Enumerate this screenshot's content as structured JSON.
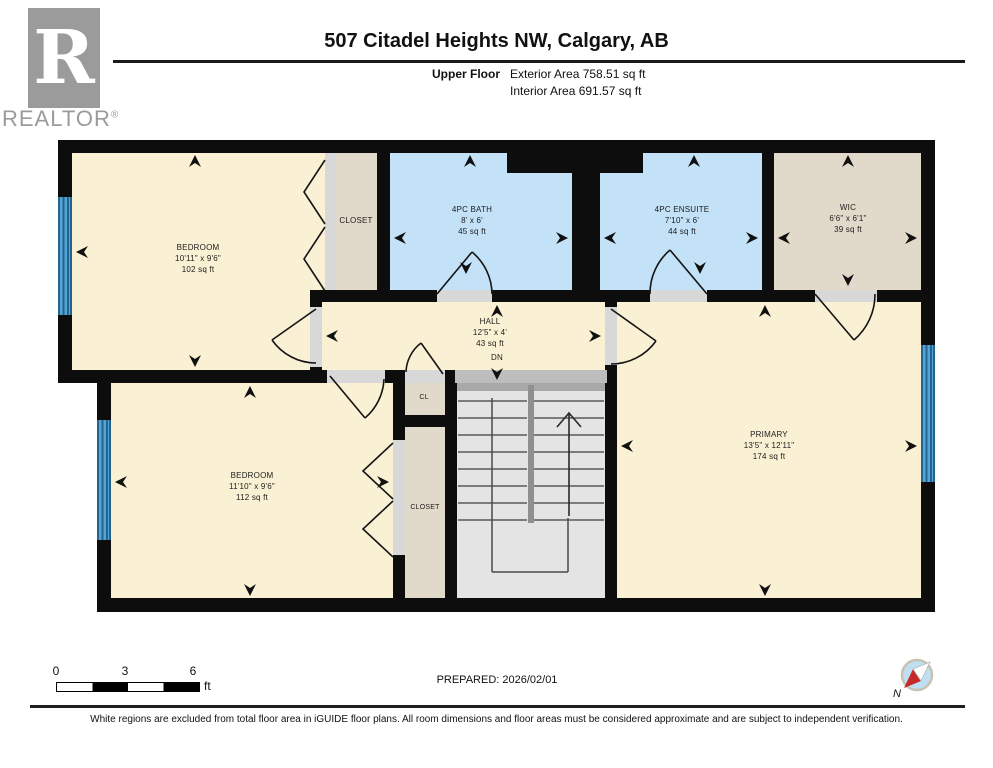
{
  "colors": {
    "wall": "#0D0D0D",
    "room_cream": "#FAF0D4",
    "room_blue": "#C3E1F7",
    "room_tan": "#E1DACA",
    "stairs_gray": "#E4E4E4",
    "threshold_gray": "#D8D8D8",
    "window_blue": "#4FA0D4",
    "compass_red": "#C62828",
    "logo_gray": "#9B9B9B"
  },
  "header": {
    "logo_letter": "R",
    "logo_wordmark": "REALTOR",
    "logo_reg": "®",
    "title": "507 Citadel Heights NW, Calgary, AB",
    "floor_label": "Upper Floor",
    "exterior_area": "Exterior Area 758.51 sq ft",
    "interior_area": "Interior Area 691.57 sq ft"
  },
  "rooms": {
    "bedroom1": {
      "name": "BEDROOM",
      "dims": "10'11\" x 9'6\"",
      "area": "102 sq ft"
    },
    "closet1": {
      "name": "CLOSET"
    },
    "bath": {
      "name": "4PC BATH",
      "dims": "8' x 6'",
      "area": "45 sq ft"
    },
    "ensuite": {
      "name": "4PC ENSUITE",
      "dims": "7'10\" x 6'",
      "area": "44 sq ft"
    },
    "wic": {
      "name": "WIC",
      "dims": "6'6\" x 6'1\"",
      "area": "39 sq ft"
    },
    "hall": {
      "name": "HALL",
      "dims": "12'5\" x 4'",
      "area": "43 sq ft"
    },
    "dn": {
      "label": "DN"
    },
    "cl": {
      "name": "CL"
    },
    "closet2": {
      "name": "CLOSET"
    },
    "bedroom2": {
      "name": "BEDROOM",
      "dims": "11'10\" x 9'6\"",
      "area": "112 sq ft"
    },
    "primary": {
      "name": "PRIMARY",
      "dims": "13'5\" x 12'11\"",
      "area": "174 sq ft"
    }
  },
  "footer": {
    "scale_ticks": [
      "0",
      "3",
      "6"
    ],
    "scale_unit": "ft",
    "prepared": "PREPARED: 2026/02/01",
    "compass_label": "N",
    "disclaimer": "White regions are excluded from total floor area in iGUIDE floor plans. All room dimensions and floor areas must be considered approximate and are subject to independent verification."
  }
}
